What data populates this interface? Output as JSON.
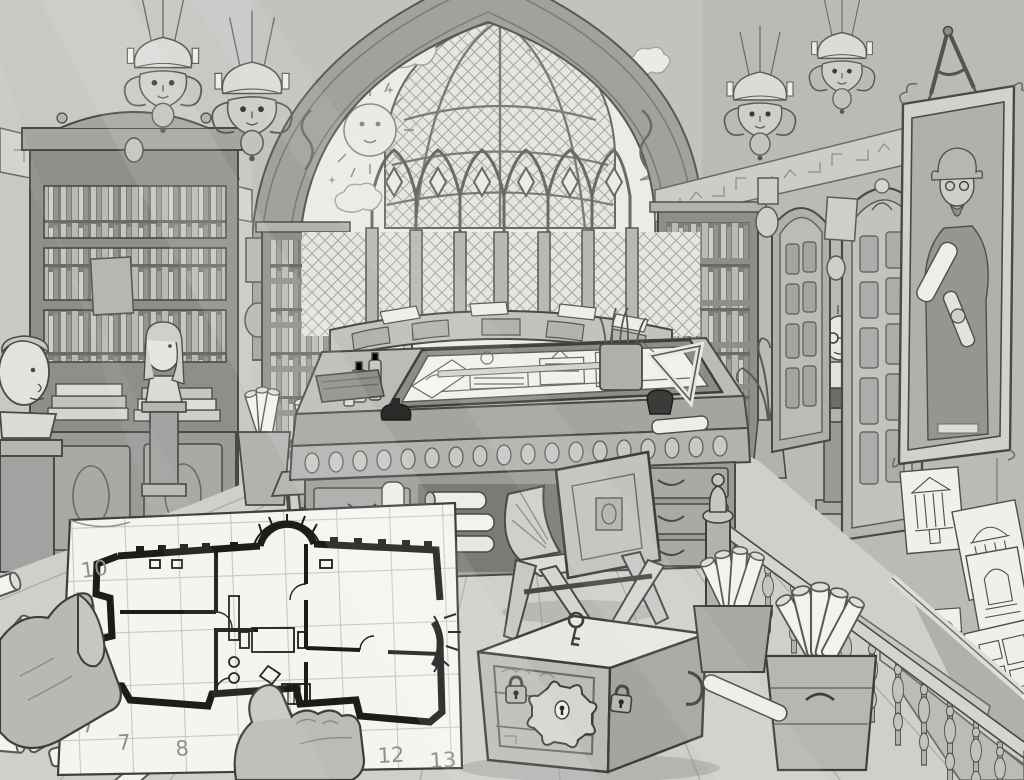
{
  "scene": {
    "title": "Architect's gothic study — ink illustration",
    "medium": "black-and-white pen illustration",
    "objects": [
      "glass-dome-skylight",
      "pointed-arch-with-dragon-reliefs",
      "sun-face-mural",
      "crescent-moon-mural",
      "star-mural",
      "grotesque-face-chandeliers",
      "city-skyline-frieze",
      "tall-bookcase",
      "recessed-bookshelves",
      "male-bust",
      "female-bust",
      "spectacled-bust",
      "gothic-doors",
      "ornate-engraved-door",
      "drafting-desk",
      "drawing-board-with-elevation-sketch",
      "ink-bottles",
      "pen-cups",
      "set-square",
      "folding-x-chair",
      "locked-strongbox-with-key",
      "padlocks",
      "scroll-buckets",
      "scroll-pile",
      "stair-banister",
      "steps",
      "framed-architect-portrait",
      "drafting-divider-compass",
      "pinned-architectural-sketches",
      "hanging-spider",
      "hands-holding-floor-plan",
      "gridded-floor-plan-sheet"
    ]
  },
  "plan": {
    "left_axis_labels": [
      "10",
      "9",
      "7"
    ],
    "bottom_axis_labels": [
      "7",
      "8",
      "12",
      "13"
    ]
  },
  "palette": {
    "paper": "#f3f2ee",
    "wall": "#c6c5c2",
    "mid": "#a9a8a5",
    "dark": "#6b6a68",
    "ink": "#1d1c1a"
  }
}
